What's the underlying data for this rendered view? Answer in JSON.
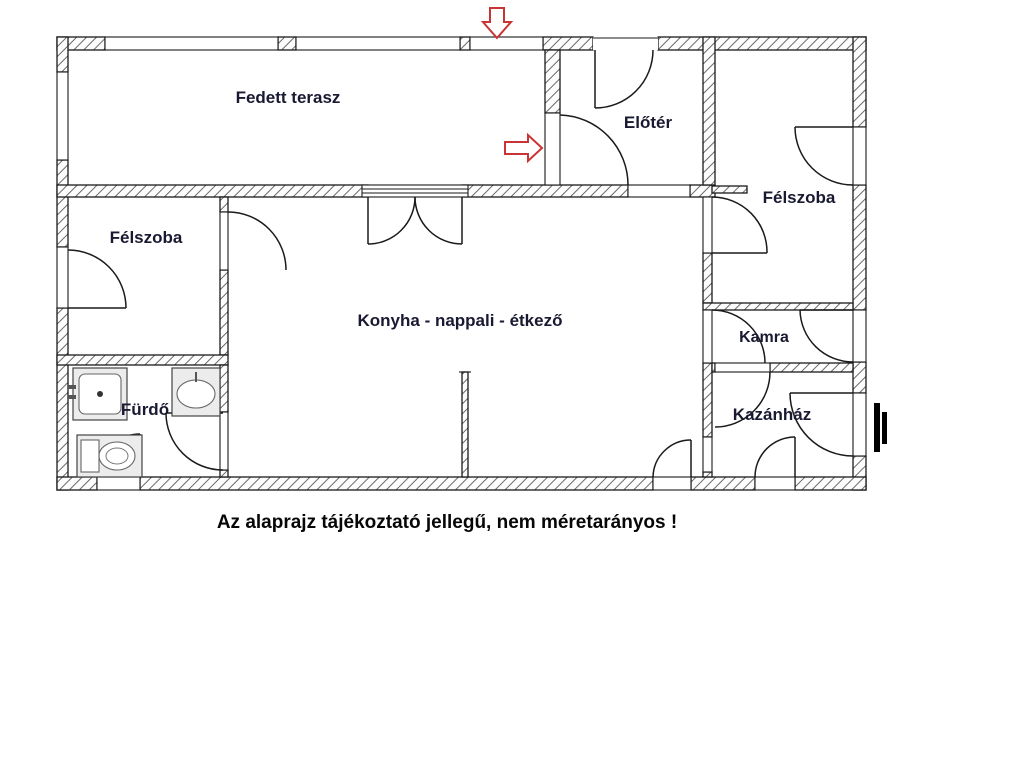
{
  "floor_plan": {
    "rooms": [
      {
        "id": "fedett-terasz",
        "label": "Fedett terasz"
      },
      {
        "id": "eloter",
        "label": "Előtér"
      },
      {
        "id": "felszoba-right",
        "label": "Félszoba"
      },
      {
        "id": "felszoba-left",
        "label": "Félszoba"
      },
      {
        "id": "konyha",
        "label": "Konyha  - nappali - étkező"
      },
      {
        "id": "kamra",
        "label": "Kamra"
      },
      {
        "id": "kazanhaz",
        "label": "Kazánház"
      },
      {
        "id": "furdo",
        "label": "Fürdő"
      }
    ],
    "caption": "Az alaprajz tájékoztató jellegű, nem méretarányos !",
    "icons": {
      "arrows": [
        "entrance-arrow-down",
        "entrance-arrow-right"
      ],
      "fixtures": [
        "shower-tray",
        "washbasin",
        "toilet"
      ],
      "markers": [
        "double-black-bars"
      ]
    },
    "colors": {
      "wall_line": "#1a1a1a",
      "hatch": "#6a6a6a",
      "label_text": "#191932",
      "caption_text": "#070707",
      "arrow_red": "#c93434",
      "fixture_fill": "#ececec"
    }
  }
}
